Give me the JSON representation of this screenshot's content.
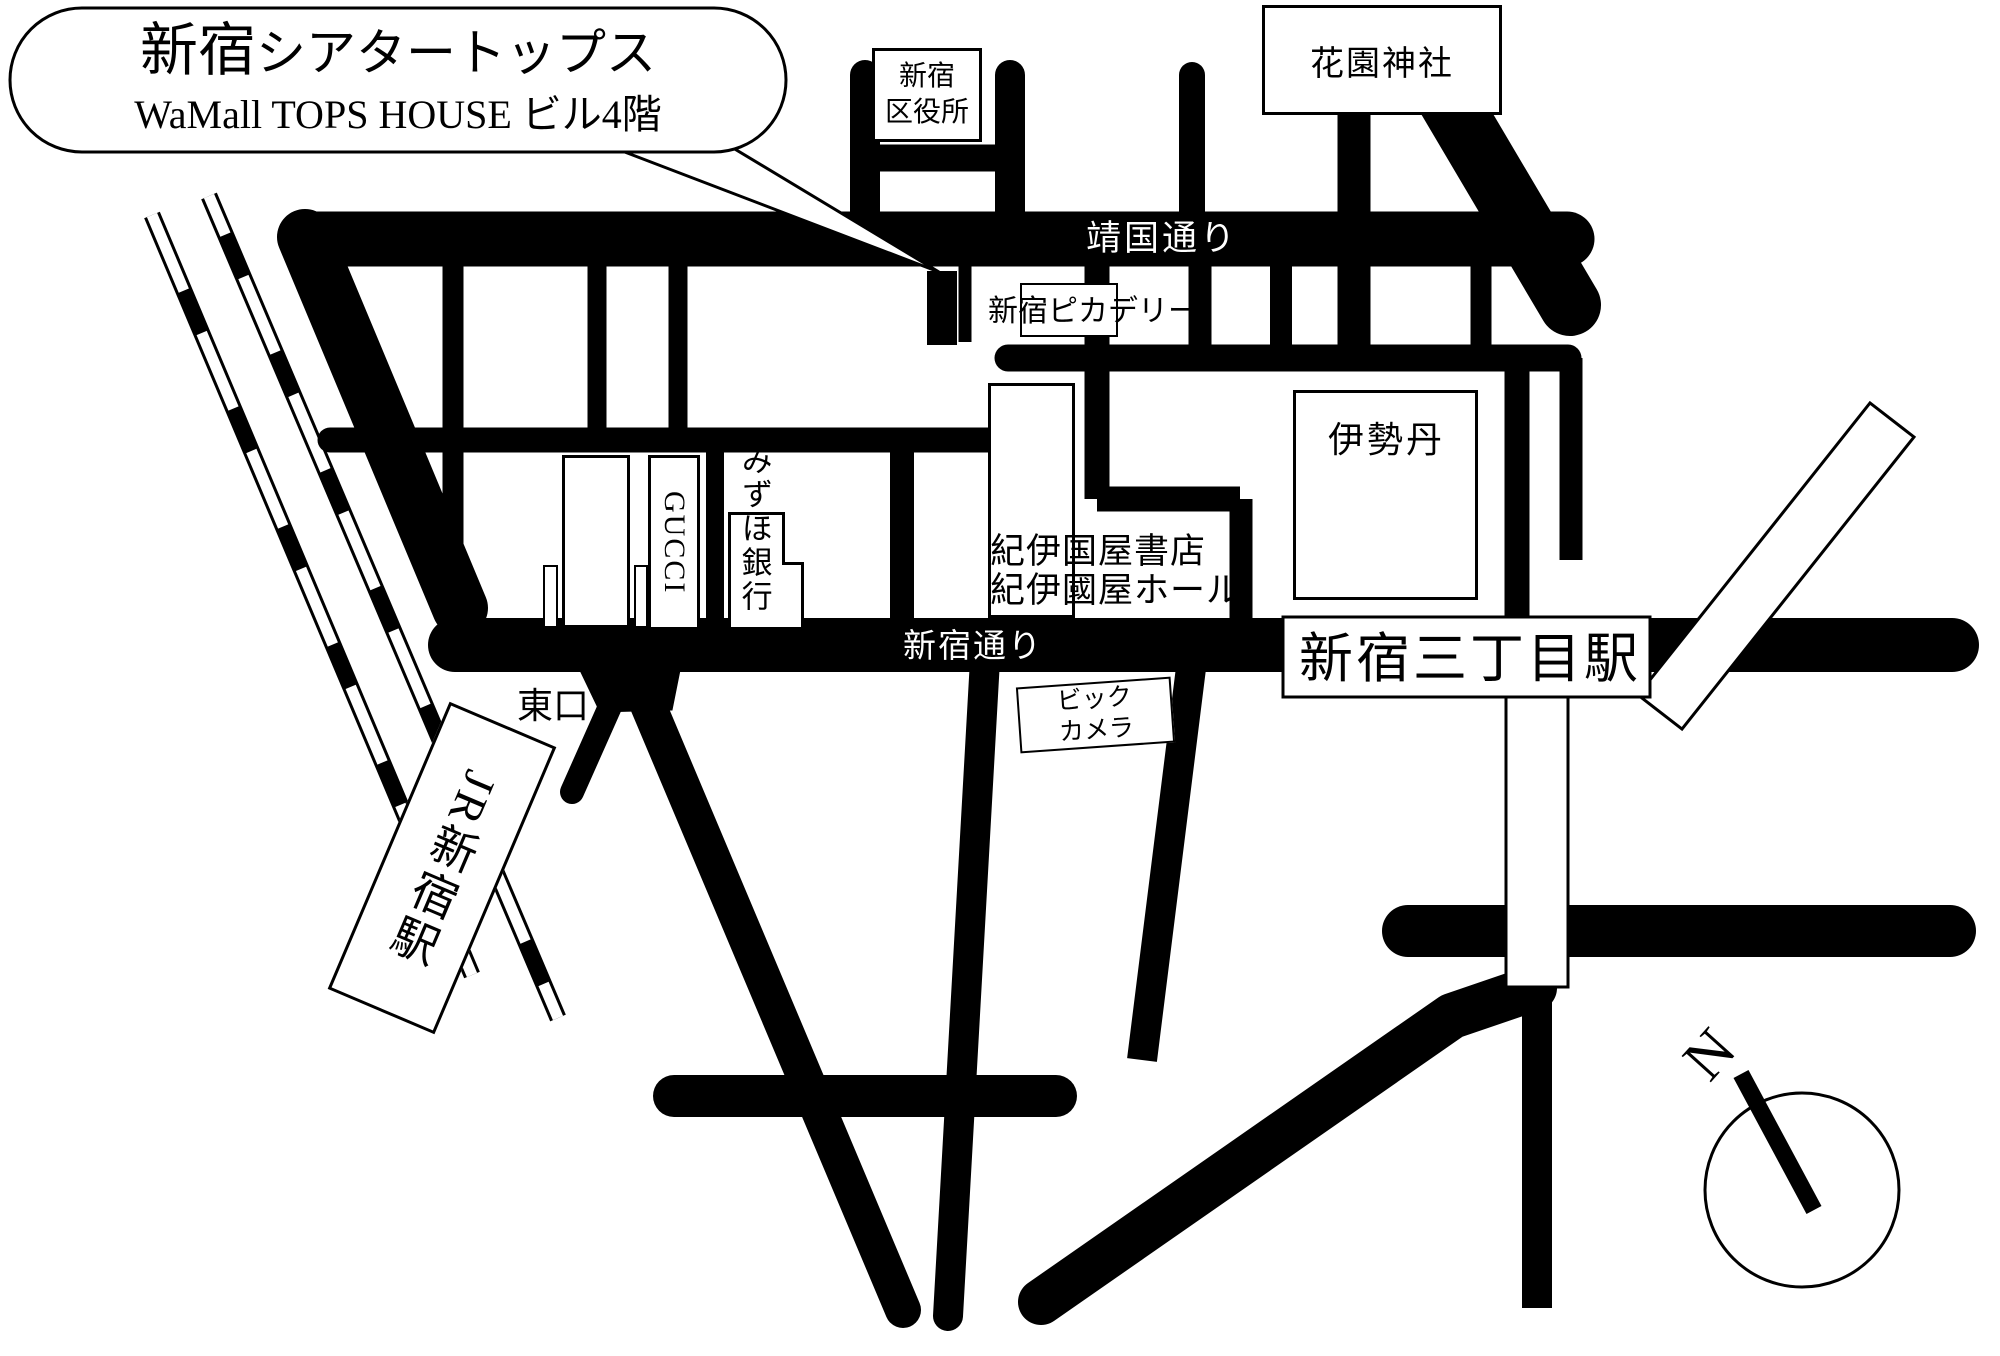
{
  "colors": {
    "ink": "#000000",
    "paper": "#ffffff"
  },
  "callout": {
    "title_prefix": "新宿",
    "title_rest": "シアタートップス",
    "subtitle": "WaMall TOPS HOUSE ビル4階"
  },
  "roads": {
    "yasukuni_dori": "靖国通り",
    "shinjuku_dori": "新宿通り"
  },
  "places": {
    "ward_office_line1": "新宿",
    "ward_office_line2": "区役所",
    "hanazono_shrine": "花園神社",
    "picadilly": "新宿ピカデリー",
    "gucci": "GUCCI",
    "mizuho_bank": "みずほ銀行",
    "kinokuniya_line1": "紀伊国屋書店",
    "kinokuniya_line2": "紀伊國屋ホール",
    "isetan": "伊勢丹",
    "bic_camera_line1": "ビック",
    "bic_camera_line2": "カメラ",
    "east_exit": "東口",
    "jr_shinjuku_station": "JR新宿駅",
    "shinjuku_sanchome_station": "新宿三丁目駅"
  },
  "compass": {
    "north_label": "N"
  }
}
